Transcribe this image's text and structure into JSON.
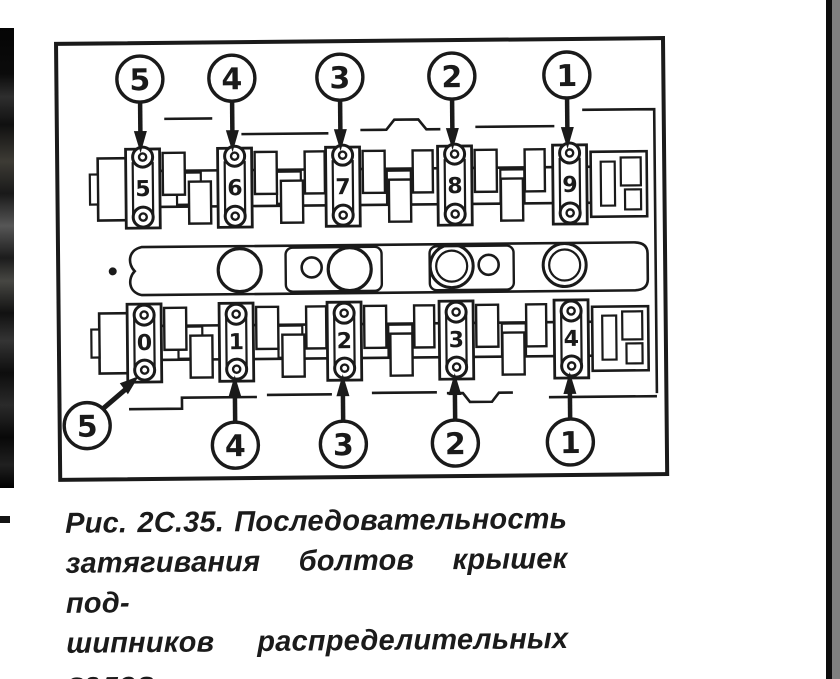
{
  "page": {
    "background": "#ffffff",
    "ink_color": "#1a1a1a",
    "right_gray_strip_color": "#7f7f7f"
  },
  "figure": {
    "caption": {
      "lines": [
        "Рис. 2C.35. Последовательность",
        "затягивания болтов крышек под-",
        "шипников распределительных",
        "валов."
      ]
    },
    "diagram": {
      "type": "bolt-tightening-sequence",
      "top_sequence_callouts": [
        {
          "label": "5",
          "x": 142
        },
        {
          "label": "4",
          "x": 234
        },
        {
          "label": "3",
          "x": 342
        },
        {
          "label": "2",
          "x": 454
        },
        {
          "label": "1",
          "x": 569
        }
      ],
      "bottom_sequence_callouts": [
        {
          "label": "4",
          "x": 234
        },
        {
          "label": "3",
          "x": 342
        },
        {
          "label": "2",
          "x": 454
        },
        {
          "label": "1",
          "x": 569
        }
      ],
      "bottom_left_callout": {
        "label": "5",
        "x": 86,
        "y": 423
      },
      "bearing_caps": {
        "top": {
          "labels": [
            "5",
            "6",
            "7",
            "8",
            "9"
          ],
          "x": [
            144,
            236,
            344,
            456,
            571
          ]
        },
        "bottom": {
          "labels": [
            "0",
            "1",
            "2",
            "3",
            "4"
          ],
          "x": [
            144,
            236,
            344,
            456,
            571
          ]
        }
      }
    }
  }
}
